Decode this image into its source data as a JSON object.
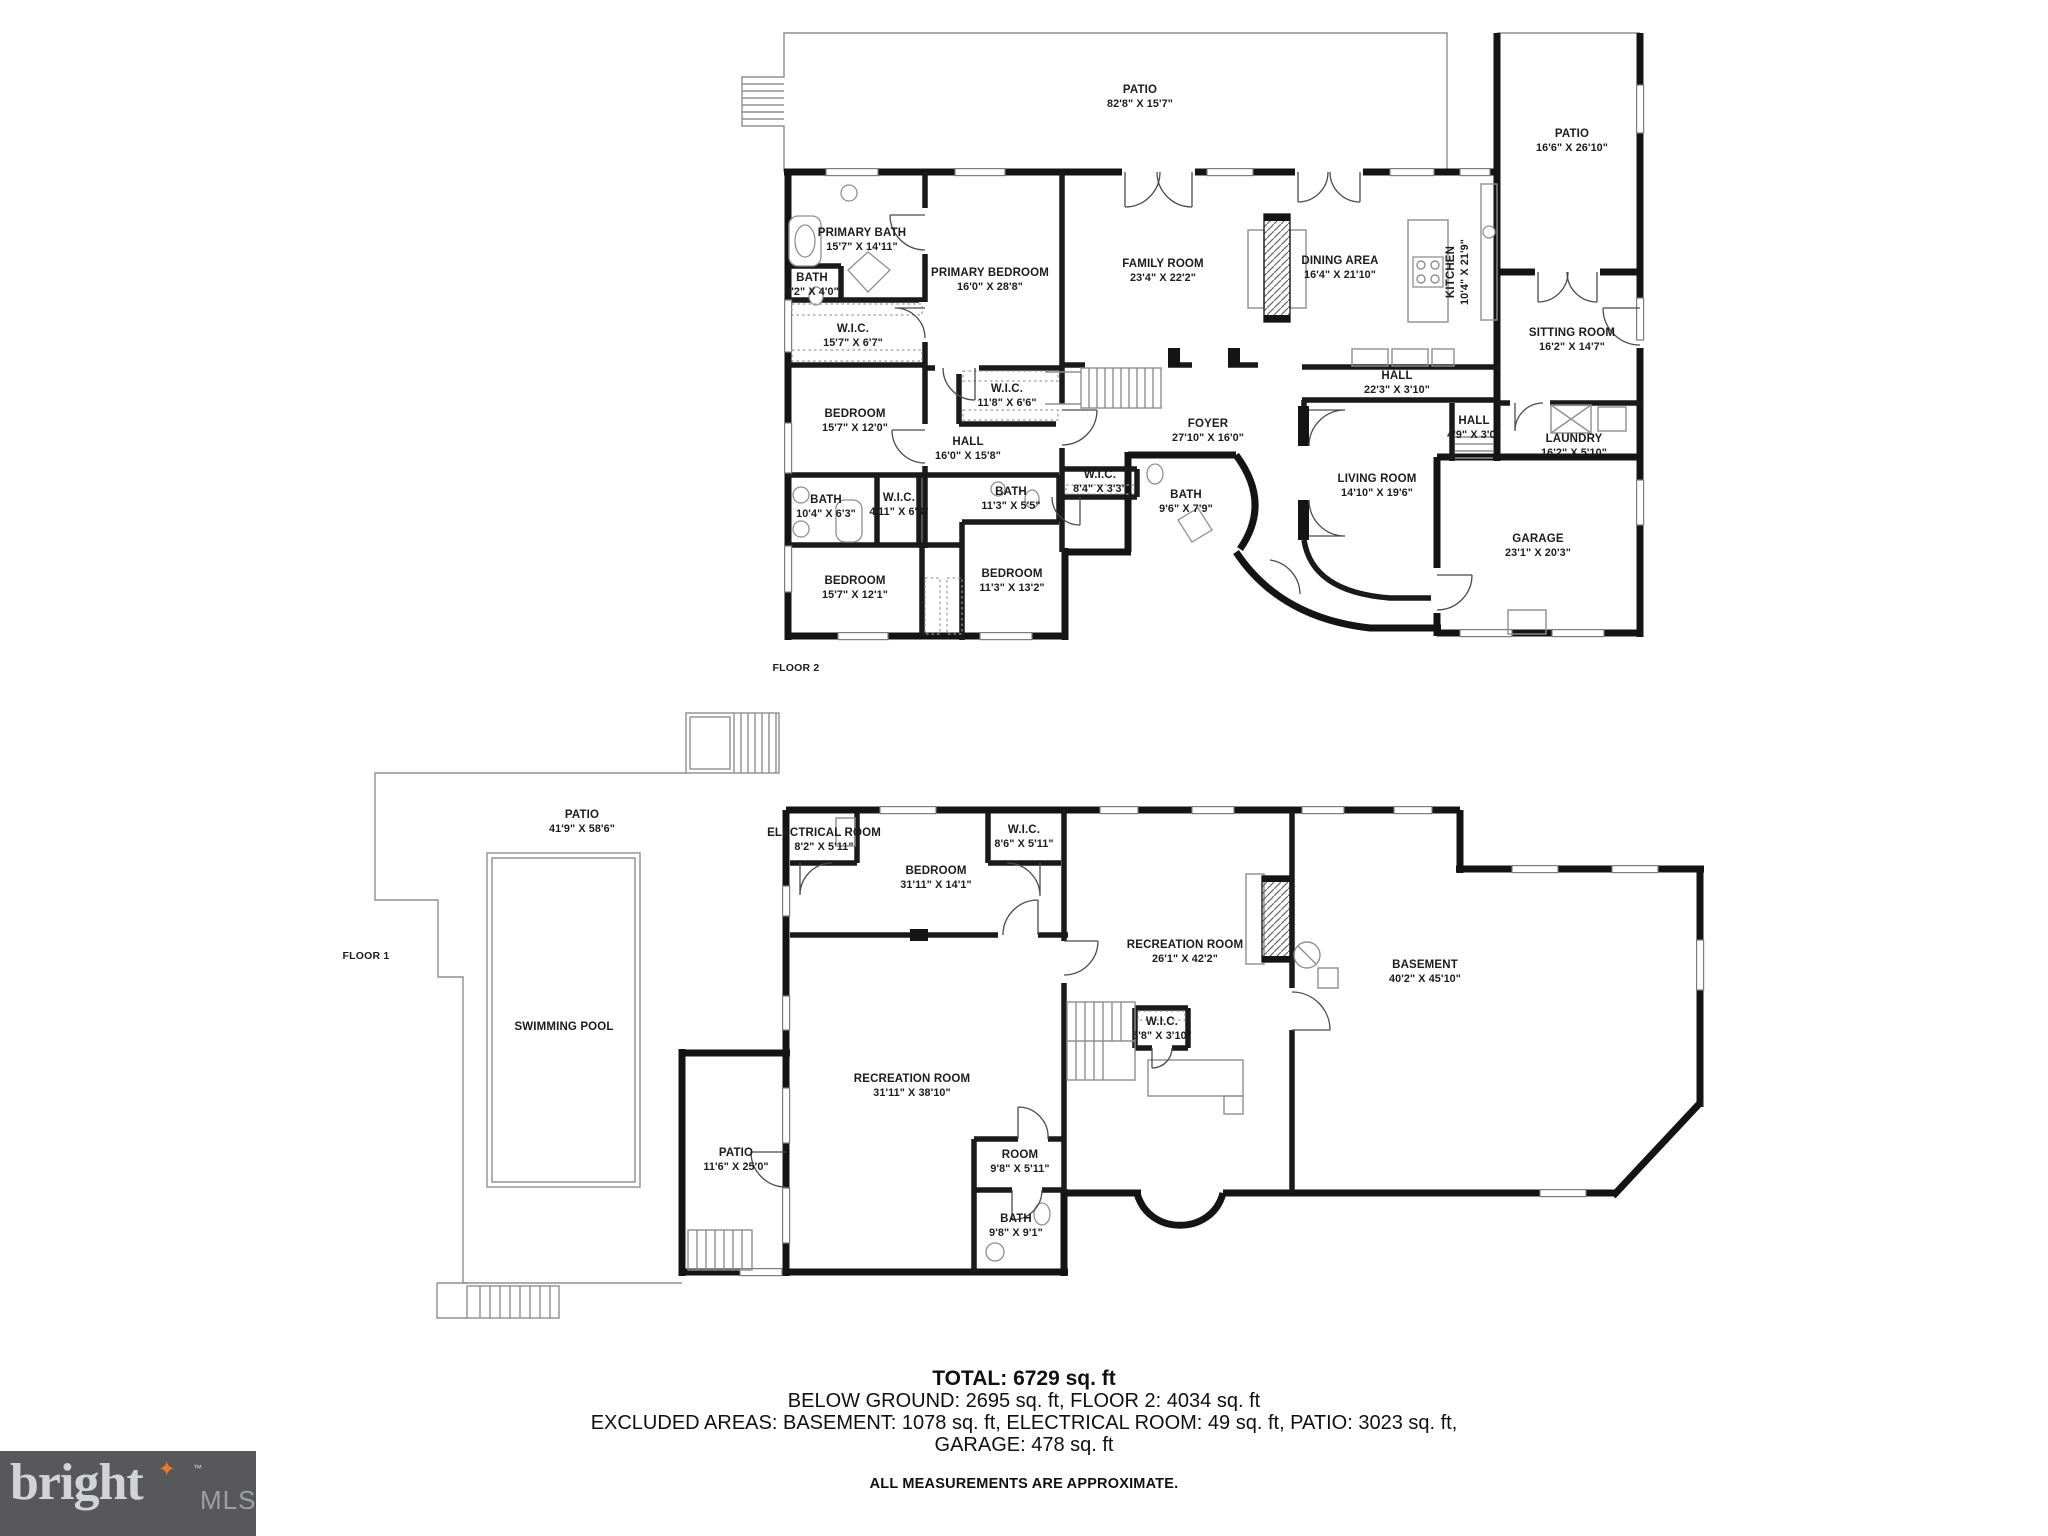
{
  "floor2": {
    "label": "FLOOR 2",
    "tag_x": 796,
    "tag_y": 668,
    "rooms": [
      {
        "name": "PATIO",
        "dims": "82'8\" X 15'7\"",
        "x": 1140,
        "y": 97
      },
      {
        "name": "PATIO",
        "dims": "16'6\" X 26'10\"",
        "x": 1572,
        "y": 141
      },
      {
        "name": "PRIMARY BATH",
        "dims": "15'7\" X 14'11\"",
        "x": 862,
        "y": 240
      },
      {
        "name": "BATH",
        "dims": "6'2\" X 4'0\"",
        "x": 812,
        "y": 285
      },
      {
        "name": "W.I.C.",
        "dims": "15'7\" X 6'7\"",
        "x": 853,
        "y": 336
      },
      {
        "name": "PRIMARY BEDROOM",
        "dims": "16'0\" X 28'8\"",
        "x": 990,
        "y": 280
      },
      {
        "name": "FAMILY ROOM",
        "dims": "23'4\" X 22'2\"",
        "x": 1163,
        "y": 271
      },
      {
        "name": "DINING AREA",
        "dims": "16'4\" X 21'10\"",
        "x": 1340,
        "y": 268
      },
      {
        "name": "KITCHEN",
        "dims": "10'4\" X 21'9\"",
        "x": 1458,
        "y": 272,
        "rot": -90
      },
      {
        "name": "SITTING ROOM",
        "dims": "16'2\" X 14'7\"",
        "x": 1572,
        "y": 340
      },
      {
        "name": "HALL",
        "dims": "22'3\" X 3'10\"",
        "x": 1397,
        "y": 383
      },
      {
        "name": "HALL",
        "dims": "4'9\" X 3'0\"",
        "x": 1474,
        "y": 428
      },
      {
        "name": "LAUNDRY",
        "dims": "16'2\" X 5'10\"",
        "x": 1574,
        "y": 446
      },
      {
        "name": "BEDROOM",
        "dims": "15'7\" X 12'0\"",
        "x": 855,
        "y": 421
      },
      {
        "name": "W.I.C.",
        "dims": "11'8\" X 6'6\"",
        "x": 1007,
        "y": 396
      },
      {
        "name": "HALL",
        "dims": "16'0\" X 15'8\"",
        "x": 968,
        "y": 449
      },
      {
        "name": "FOYER",
        "dims": "27'10\" X 16'0\"",
        "x": 1208,
        "y": 431
      },
      {
        "name": "BATH",
        "dims": "10'4\" X 6'3\"",
        "x": 826,
        "y": 507
      },
      {
        "name": "W.I.C.",
        "dims": "4'11\" X 6'3\"",
        "x": 899,
        "y": 505
      },
      {
        "name": "BATH",
        "dims": "11'3\" X 5'5\"",
        "x": 1011,
        "y": 499
      },
      {
        "name": "W.I.C.",
        "dims": "8'4\" X 3'3\"",
        "x": 1100,
        "y": 482
      },
      {
        "name": "BATH",
        "d ims": "",
        "dims": "9'6\" X 7'9\"",
        "x": 1186,
        "y": 502
      },
      {
        "name": "LIVING ROOM",
        "dims": "14'10\" X 19'6\"",
        "x": 1377,
        "y": 486
      },
      {
        "name": "BEDROOM",
        "dims": "15'7\" X 12'1\"",
        "x": 855,
        "y": 588
      },
      {
        "name": "BEDROOM",
        "dims": "11'3\" X 13'2\"",
        "x": 1012,
        "y": 581
      },
      {
        "name": "GARAGE",
        "dims": "23'1\" X 20'3\"",
        "x": 1538,
        "y": 546
      }
    ]
  },
  "floor1": {
    "label": "FLOOR 1",
    "tag_x": 366,
    "tag_y": 956,
    "rooms": [
      {
        "name": "PATIO",
        "dims": "41'9\" X 58'6\"",
        "x": 582,
        "y": 822
      },
      {
        "name": "SWIMMING POOL",
        "dims": "",
        "x": 564,
        "y": 1028
      },
      {
        "name": "ELECTRICAL ROOM",
        "dims": "8'2\" X 5'11\"",
        "x": 824,
        "y": 840
      },
      {
        "name": "BEDROOM",
        "dims": "31'11\" X 14'1\"",
        "x": 936,
        "y": 878
      },
      {
        "name": "W.I.C.",
        "dims": "8'6\" X 5'11\"",
        "x": 1024,
        "y": 837
      },
      {
        "name": "RECREATION ROOM",
        "dims": "26'1\" X 42'2\"",
        "x": 1185,
        "y": 952
      },
      {
        "name": "W.I.C.",
        "dims": "5'8\" X 3'10\"",
        "x": 1162,
        "y": 1029
      },
      {
        "name": "BASEMENT",
        "dims": "40'2\" X 45'10\"",
        "x": 1425,
        "y": 972
      },
      {
        "name": "RECREATION ROOM",
        "dims": "31'11\" X 38'10\"",
        "x": 912,
        "y": 1086
      },
      {
        "name": "PATIO",
        "dims": "11'6\" X 25'0\"",
        "x": 736,
        "y": 1160
      },
      {
        "name": "ROOM",
        "dims": "9'8\" X 5'11\"",
        "x": 1020,
        "y": 1162
      },
      {
        "name": "BATH",
        "dims": "9'8\" X 9'1\"",
        "x": 1016,
        "y": 1226
      }
    ]
  },
  "summary": {
    "total": "TOTAL: 6729 sq. ft",
    "line2": "BELOW GROUND: 2695 sq. ft, FLOOR 2: 4034 sq. ft",
    "line3": "EXCLUDED AREAS: BASEMENT: 1078 sq. ft, ELECTRICAL ROOM: 49 sq. ft, PATIO: 3023 sq. ft,",
    "line4": "GARAGE: 478 sq. ft",
    "disclaimer": "ALL MEASUREMENTS ARE APPROXIMATE."
  },
  "logo": {
    "brand": "bright",
    "suffix": "MLS",
    "tm": "TM",
    "bg": "#58585a",
    "brand_color": "#d2d3d4",
    "suffix_color": "#9da0a3",
    "star_color": "#e87a2a",
    "star": "✦"
  }
}
